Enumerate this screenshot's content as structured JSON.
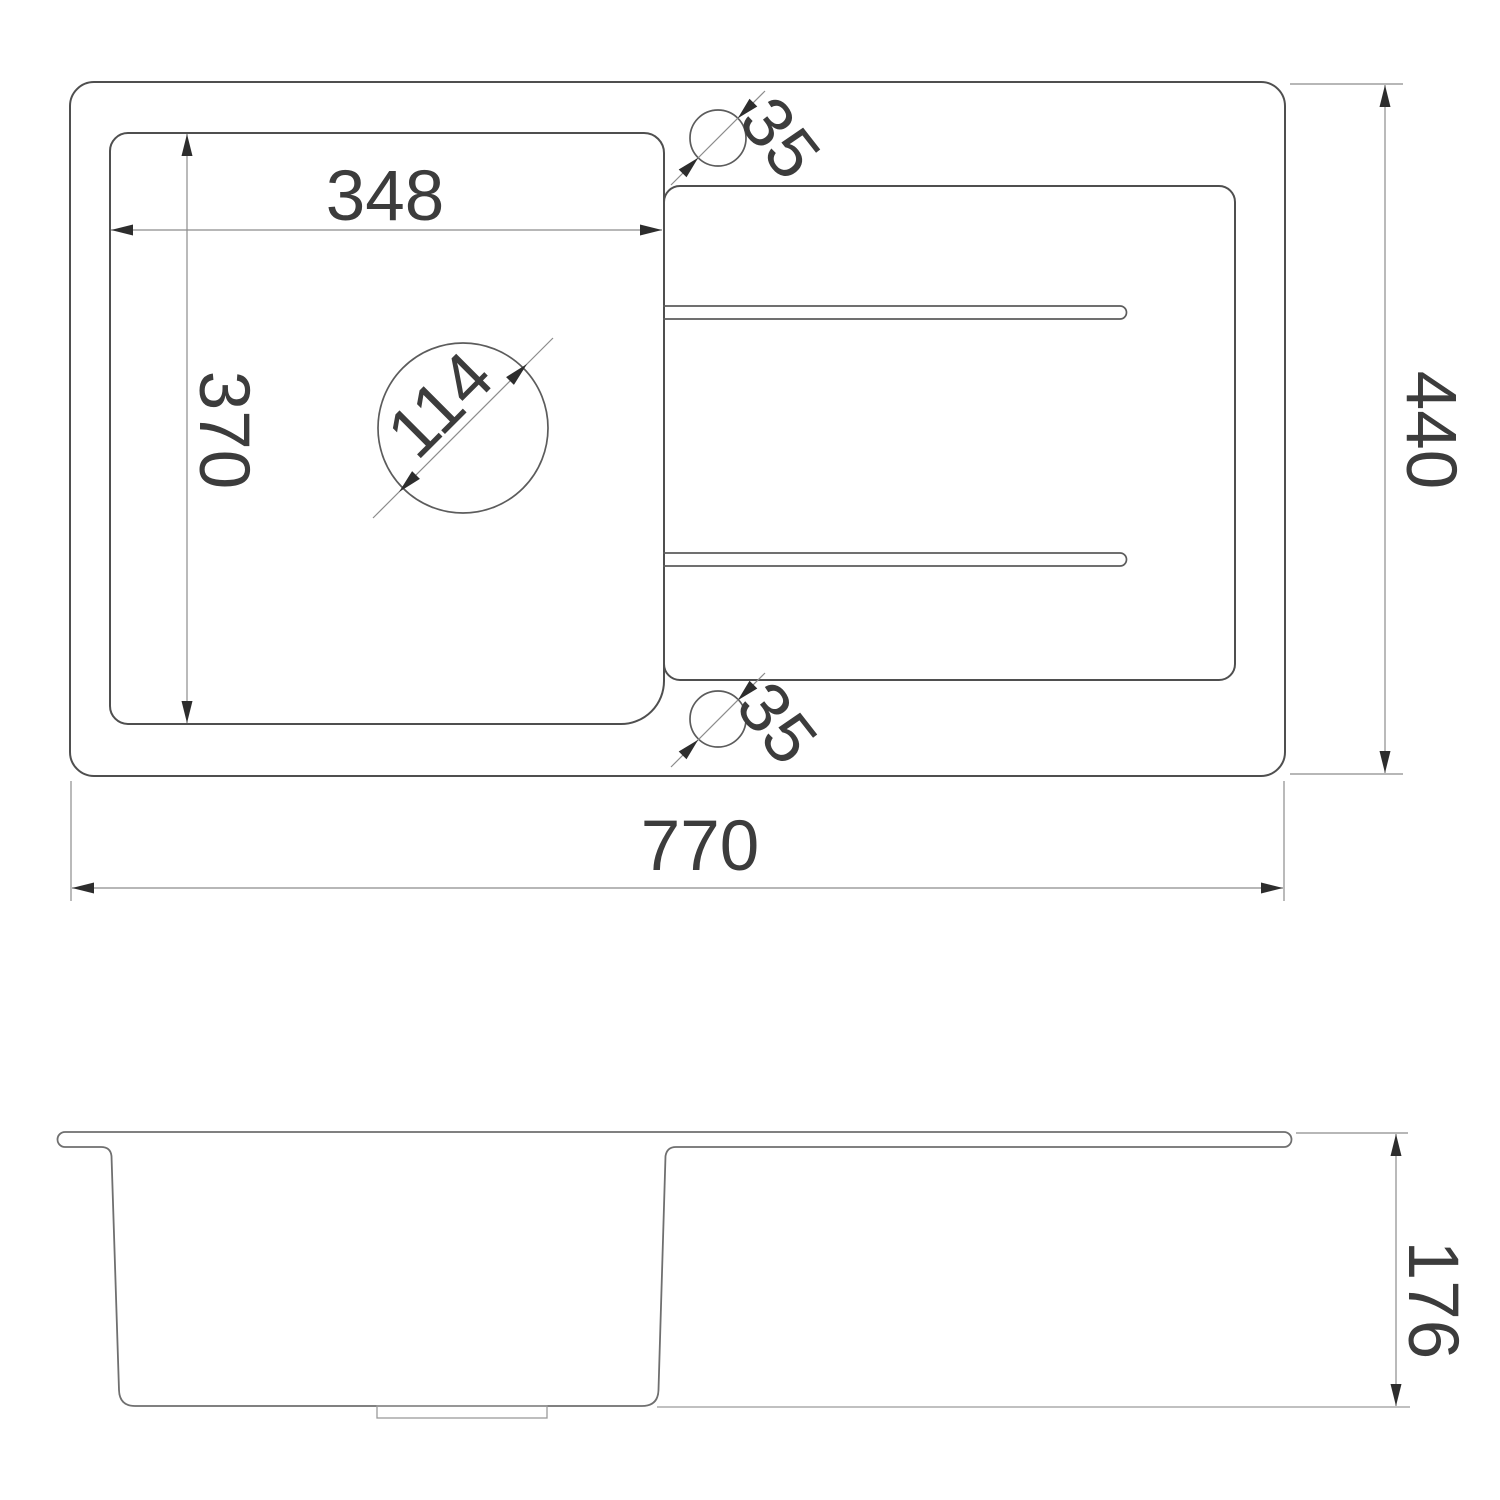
{
  "page": {
    "background_color": "#ffffff",
    "description": "Dimensioned technical drawing of a kitchen sink, top view and side view"
  },
  "top_view": {
    "bowl_width": "348",
    "bowl_depth": "370",
    "drain_hole_diameter": "114",
    "tap_hole_top_diameter": "35",
    "tap_hole_bottom_diameter": "35",
    "overall_width": "770",
    "overall_depth": "440"
  },
  "side_view": {
    "bowl_height": "176"
  },
  "style": {
    "outline_color": "#4f4f4f",
    "side_outline_color": "#6f6f6f",
    "dimension_line_color": "#8c8c8c",
    "arrow_color": "#2d2d2d",
    "text_color": "#3c3c3c"
  }
}
